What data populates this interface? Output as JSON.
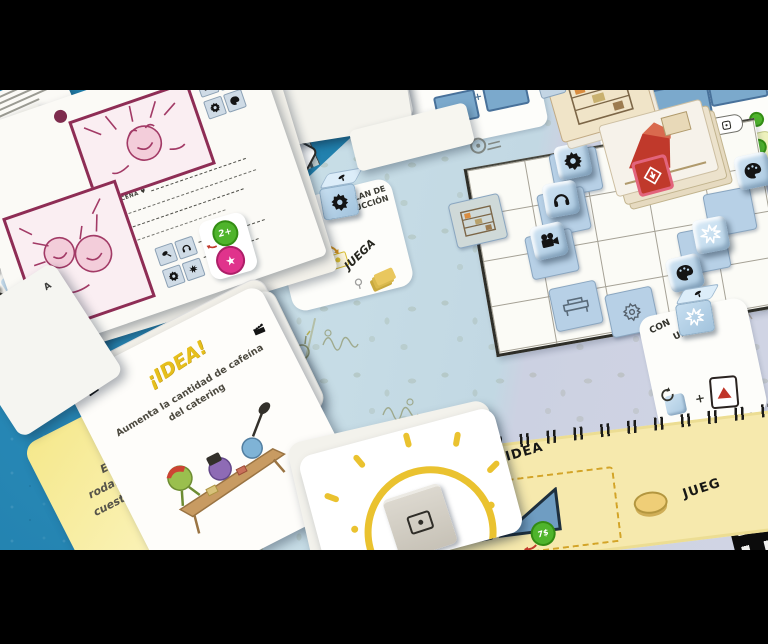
{
  "meta": {
    "scene": "Photograph of the board game Cámara Roll set up on a blue tablecloth"
  },
  "board": {
    "organiza": "ORGANIZA",
    "revuelve": "REVUELVE",
    "set": "SET",
    "x5": "x5 =",
    "diamond_coin": "3$",
    "plan_line1": "PLAN DE",
    "plan_line2": "PRODUCCIÓN",
    "plan_juega": "JUEGA",
    "con": "CON",
    "un": "UN",
    "plus": "+",
    "idea_row": "JUEGA ESTA IDEA",
    "idea_row_partial": "JUEG",
    "idea_coin": "7$"
  },
  "camara_card": {
    "title1": "CÁMARA",
    "title2_pre": "R",
    "title2_post": "LL",
    "subtitle": "EL JUEGO DE HACER PELÍCULAS",
    "author": "de Malachi Ray Rempen"
  },
  "storyboard": {
    "escena": "ESCENA ♥",
    "bonus": "2+"
  },
  "badges": {
    "star": "★"
  },
  "idea_card": {
    "title": "¡IDEA!",
    "body": "Aumenta la cantidad de cafeína del catering"
  },
  "effect_card": {
    "line1": "Este turno",
    "line2": "rodar las Escenas",
    "line3_pre": "cuestan",
    "badge": "2",
    "line3_post": "menos"
  },
  "gray_card": {
    "label": "A"
  },
  "dice_icons": [
    "gear",
    "sound",
    "camera",
    "palette",
    "light",
    "mic"
  ]
}
